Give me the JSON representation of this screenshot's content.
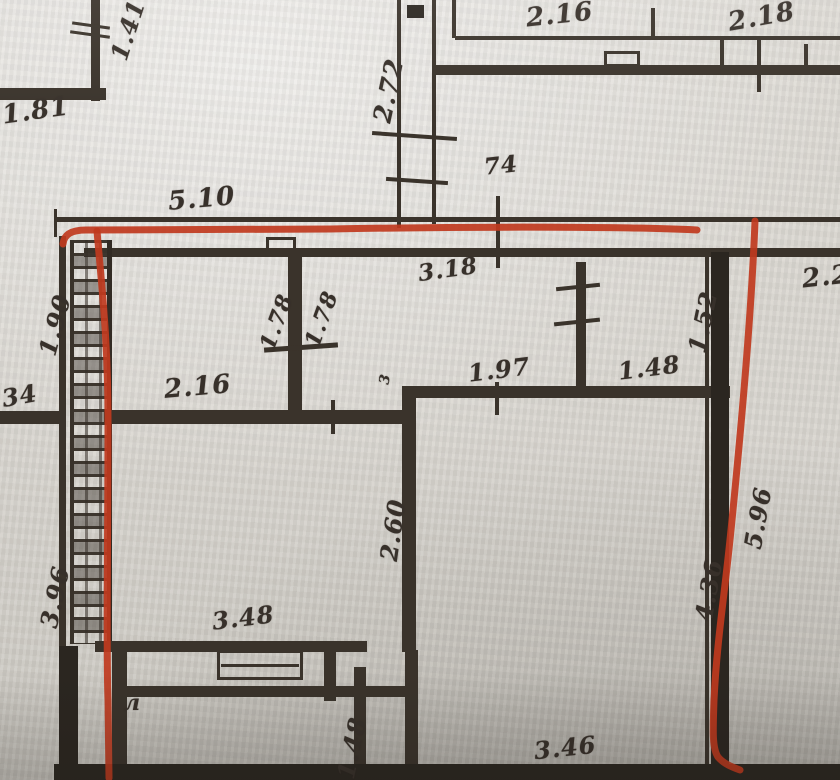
{
  "document": {
    "kind": "scanned floor plan photograph",
    "annotation": "red marker outline traced around one apartment unit"
  },
  "colors": {
    "paper": "#d9d6d0",
    "ink": "#3a332b",
    "annotation": "#c0391e",
    "bottom_shadow": "#262019"
  },
  "labels": {
    "l141": "1.41",
    "l181": "1.81",
    "l510": "5.10",
    "l272": "2.72",
    "l216top": "2.16",
    "l218": "2.18",
    "l74": "74",
    "l318": "3.18",
    "l22": "2.2",
    "l190": "1.90",
    "l178a": "1.78",
    "l178b": "1.78",
    "l152": "1.52",
    "l216mid": "2.16",
    "l197": "1.97",
    "l148mid": "1.48",
    "l34": "34",
    "l3": "3",
    "l260": "2.60",
    "l396": "3.96",
    "l348": "3.48",
    "l436": "4.36",
    "l596": "5.96",
    "l148bot": "1.48",
    "l346": "3.46",
    "lL": "л"
  }
}
